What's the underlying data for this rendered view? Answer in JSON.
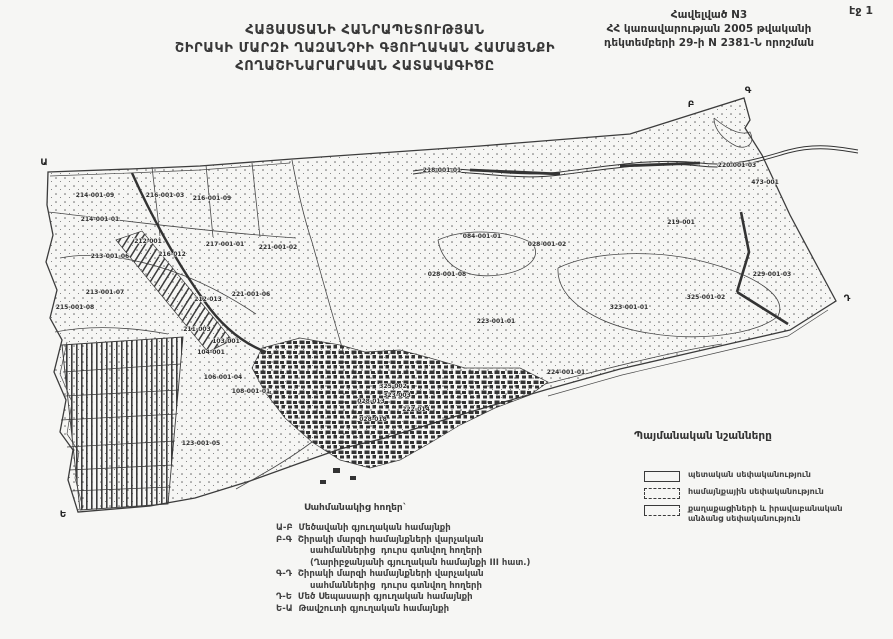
{
  "page": {
    "label": "էջ 1"
  },
  "annex": {
    "lines": [
      "Հավելված N3",
      "ՀՀ կառավարության 2005 թվականի",
      "դեկտեմբերի 29-ի N 2381-Ն որոշման"
    ]
  },
  "title": {
    "lines": [
      "ՀԱՅԱՍՏԱՆԻ ՀԱՆՐԱՊԵՏՈՒԹՅԱՆ",
      "ՇԻՐԱԿԻ ՄԱՐԶԻ ՂԱԶԱՆՉԻԻ ԳՅՈՒՂԱԿԱՆ ՀԱՄԱՅՆՔԻ",
      "ՀՈՂԱՇԻՆԱՐԱՐԱԿԱՆ ՀԱՏԱԿԱԳԻԾԸ"
    ]
  },
  "legend": {
    "title": "Պայմանական նշանները",
    "items": [
      {
        "symbol": "state-ownership-symbol",
        "style": "solid",
        "lines": [
          "պետական սեփականություն"
        ]
      },
      {
        "symbol": "community-ownership-symbol",
        "style": "dashed",
        "lines": [
          "համայնքային սեփականություն"
        ]
      },
      {
        "symbol": "private-ownership-symbol",
        "style": "half-dashed",
        "lines": [
          "քաղաքացիների և իրավաբանական",
          "անձանց սեփականություն"
        ]
      }
    ]
  },
  "border_note": {
    "title": "Սահմանակից հողեր`",
    "lines": [
      {
        "text": "Ա-Բ  Մեծավանի գյուղական համայնքի",
        "indent": false
      },
      {
        "text": "Բ-Գ  Շիրակի մարզի համայնքների վարչական",
        "indent": false
      },
      {
        "text": "սահմաններից  դուրս գտնվող հողերի",
        "indent": true
      },
      {
        "text": "(Ղարիբջանյանի գյուղական համայնքի III հատ.)",
        "indent": true
      },
      {
        "text": "Գ-Դ  Շիրակի մարզի համայնքների վարչական",
        "indent": false
      },
      {
        "text": "սահմաններից  դուրս գտնվող հողերի",
        "indent": true
      },
      {
        "text": "Դ-Ե  Մեծ Սեպասարի գյուղական համայնքի",
        "indent": false
      },
      {
        "text": "Ե-Ա  Թավշուտի գյուղական համայնքի",
        "indent": false
      }
    ]
  },
  "map": {
    "colors": {
      "ink": "#3c3c3c",
      "paper": "#f6f6f4"
    },
    "boundary_letters": [
      {
        "t": "Ա",
        "x": 44,
        "y": 165
      },
      {
        "t": "Բ",
        "x": 691,
        "y": 107
      },
      {
        "t": "Գ",
        "x": 748,
        "y": 93
      },
      {
        "t": "Դ",
        "x": 847,
        "y": 301
      },
      {
        "t": "Ե",
        "x": 63,
        "y": 517
      }
    ],
    "parcel_labels": [
      {
        "t": "214-001-09",
        "x": 95,
        "y": 197
      },
      {
        "t": "216-001-03",
        "x": 165,
        "y": 197
      },
      {
        "t": "216-001-09",
        "x": 212,
        "y": 200
      },
      {
        "t": "214-001-01",
        "x": 100,
        "y": 221
      },
      {
        "t": "212-001",
        "x": 148,
        "y": 243
      },
      {
        "t": "217-001-01",
        "x": 225,
        "y": 246
      },
      {
        "t": "213-001-06",
        "x": 110,
        "y": 258
      },
      {
        "t": "216-012",
        "x": 172,
        "y": 256
      },
      {
        "t": "213-001-07",
        "x": 105,
        "y": 294
      },
      {
        "t": "215-001-08",
        "x": 75,
        "y": 309
      },
      {
        "t": "212-013",
        "x": 208,
        "y": 301
      },
      {
        "t": "221-001-02",
        "x": 278,
        "y": 249
      },
      {
        "t": "221-001-06",
        "x": 251,
        "y": 296
      },
      {
        "t": "211-003",
        "x": 197,
        "y": 331
      },
      {
        "t": "218-001-01",
        "x": 442,
        "y": 172
      },
      {
        "t": "220-001-03",
        "x": 737,
        "y": 167
      },
      {
        "t": "473-001",
        "x": 765,
        "y": 184
      },
      {
        "t": "219-001",
        "x": 681,
        "y": 224
      },
      {
        "t": "229-001-03",
        "x": 772,
        "y": 276
      },
      {
        "t": "084-001-01",
        "x": 482,
        "y": 238
      },
      {
        "t": "028-001-02",
        "x": 547,
        "y": 246
      },
      {
        "t": "028-001-08",
        "x": 447,
        "y": 276
      },
      {
        "t": "323-001-01",
        "x": 629,
        "y": 309
      },
      {
        "t": "223-001-01",
        "x": 496,
        "y": 323
      },
      {
        "t": "325-001-02",
        "x": 706,
        "y": 299
      },
      {
        "t": "224-001-01",
        "x": 566,
        "y": 374
      },
      {
        "t": "103-001",
        "x": 226,
        "y": 343
      },
      {
        "t": "104-001",
        "x": 211,
        "y": 354
      },
      {
        "t": "106-001-04",
        "x": 223,
        "y": 379
      },
      {
        "t": "108-001-01",
        "x": 251,
        "y": 393
      },
      {
        "t": "123-001-05",
        "x": 201,
        "y": 445
      },
      {
        "t": "325-002",
        "x": 393,
        "y": 388
      },
      {
        "t": "323-003",
        "x": 397,
        "y": 397
      },
      {
        "t": "028-013",
        "x": 371,
        "y": 403
      },
      {
        "t": "222-014",
        "x": 416,
        "y": 411
      },
      {
        "t": "028-018",
        "x": 373,
        "y": 421
      }
    ]
  }
}
